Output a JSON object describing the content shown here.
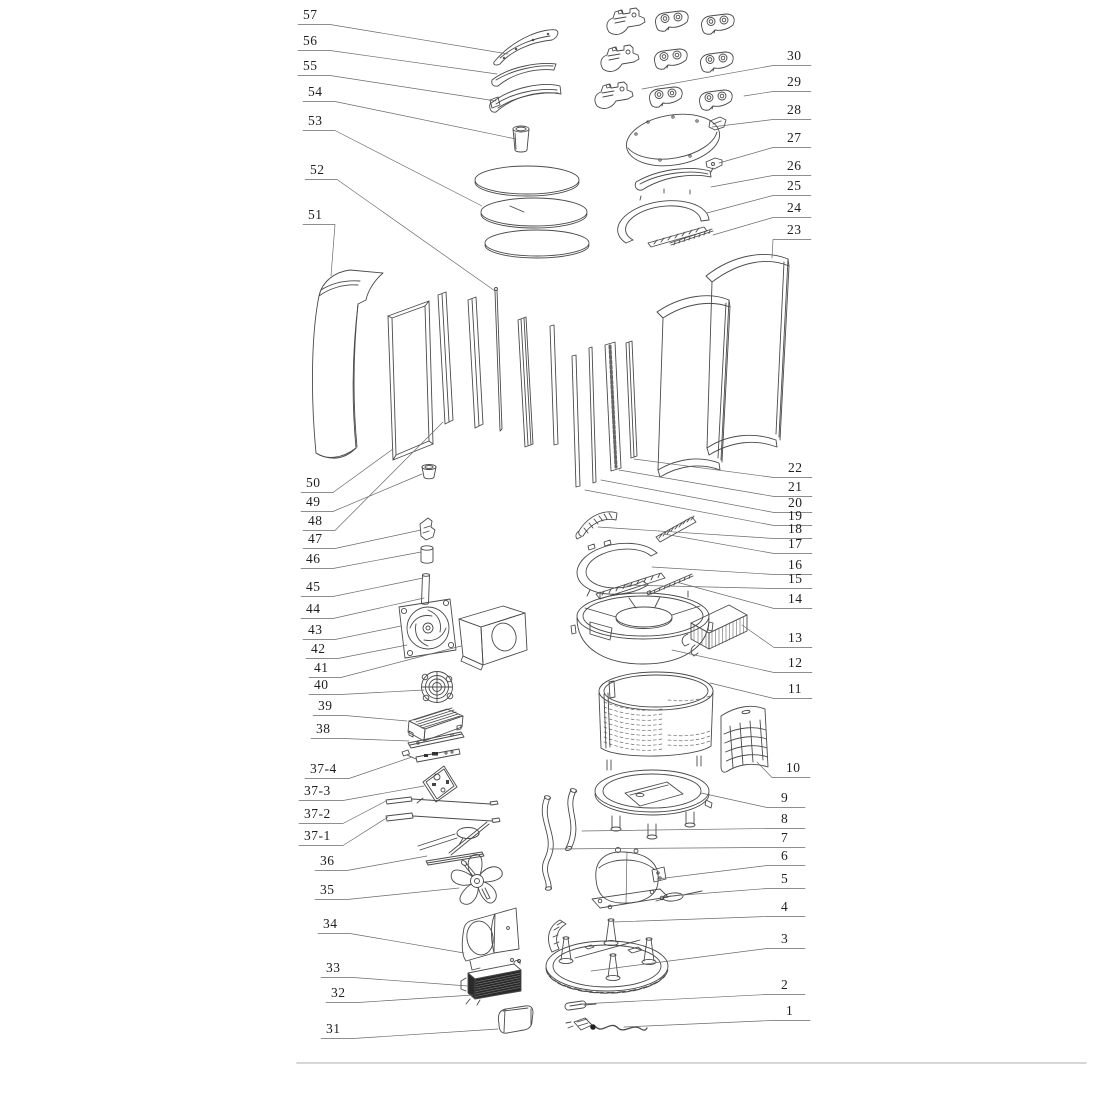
{
  "figure": {
    "type": "exploded-parts-diagram",
    "callouts": [
      "57",
      "56",
      "55",
      "54",
      "53",
      "52",
      "51",
      "50",
      "49",
      "48",
      "47",
      "46",
      "45",
      "44",
      "43",
      "42",
      "41",
      "40",
      "39",
      "38",
      "37-4",
      "37-3",
      "37-2",
      "37-1",
      "36",
      "35",
      "34",
      "33",
      "32",
      "31",
      "30",
      "29",
      "28",
      "27",
      "26",
      "25",
      "24",
      "23",
      "22",
      "21",
      "20",
      "19",
      "18",
      "17",
      "16",
      "15",
      "14",
      "13",
      "12",
      "11",
      "10",
      "9",
      "8",
      "7",
      "6",
      "5",
      "4",
      "3",
      "2",
      "1"
    ]
  },
  "colors": {
    "line": "#4a4a4a",
    "leader": "#6a6a6a",
    "label": "#1f1f1f",
    "rule": "#c8c8c8",
    "background": "#ffffff",
    "dark_fill": "#262626"
  }
}
